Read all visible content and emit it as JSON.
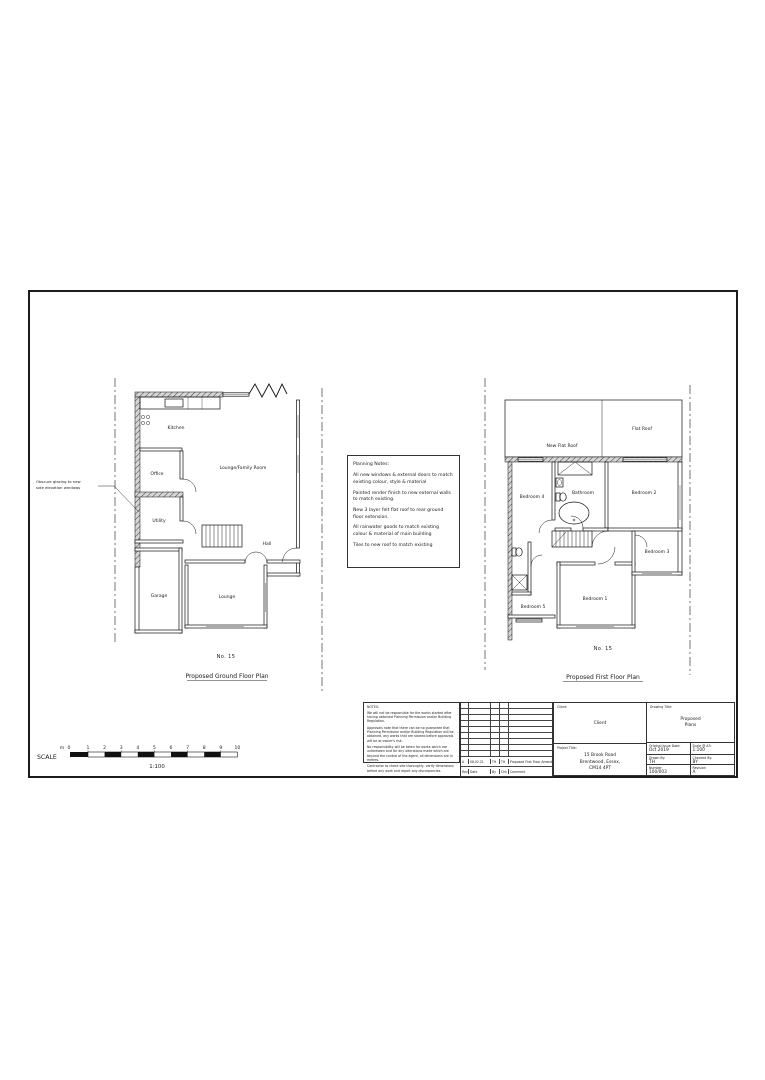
{
  "sheet": {
    "ink_color": "#1a1a1a",
    "ground_plan": {
      "annotation_lines": [
        "Obscure glazing to new",
        "side elevation windows"
      ],
      "rooms": {
        "kitchen": "Kitchen",
        "office": "Office",
        "utility": "Utility",
        "lounge_family": "Lounge/Family Room",
        "hall": "Hall",
        "garage": "Garage",
        "lounge": "Lounge"
      },
      "house_number": "No. 15",
      "caption": "Proposed Ground Floor Plan"
    },
    "first_plan": {
      "rooms": {
        "new_flat_roof": "New Flat Roof",
        "flat_roof": "Flat Roof",
        "bedroom4": "Bedroom 4",
        "bathroom": "Bathroom",
        "bedroom2": "Bedroom 2",
        "bedroom3": "Bedroom 3",
        "bedroom1": "Bedroom 1",
        "bedroom5": "Bedroom 5"
      },
      "house_number": "No. 15",
      "caption": "Proposed First Floor Plan"
    },
    "planning_notes": {
      "title": "Planning Notes:",
      "items": [
        "All new windows & external doors to match existing colour, style & material",
        "Painted render finish to new external walls to match existing.",
        "New 3 layer felt flat roof to rear ground floor extension.",
        "All rainwater goods to match existing colour & material of main building",
        "Tiles to new roof to match existing"
      ]
    },
    "scale_bar": {
      "label": "SCALE",
      "unit": "m",
      "ticks": [
        "0",
        "1",
        "2",
        "3",
        "4",
        "5",
        "6",
        "7",
        "8",
        "9",
        "10"
      ],
      "ratio": "1:100"
    },
    "notes_block": {
      "title": "NOTES:",
      "paragraphs": [
        "We will not be responsible for the works started after having obtained Planning Permission and/or Building Regulation.",
        "Approvals note that there can be no guarantee that Planning Permission and/or Building Regulation will be obtained, any works that are started before approvals will be at owner's risk.",
        "No responsibility will be taken for works which are unforeseen and for any alterations made which are beyond the control of the agent, all dimensions are in metres.",
        "Contractor to check site thoroughly, verify dimensions before any work and report any discrepancies."
      ]
    },
    "revision_table": {
      "rows": [
        [
          "A",
          "06.02.21",
          "TH",
          "TH",
          "Proposed First Floor Amended"
        ]
      ],
      "header": [
        "Rev",
        "Date",
        "By",
        "Chk",
        "Comment"
      ]
    },
    "title_block": {
      "client_label": "Client:",
      "client": "Client",
      "project_label": "Project Title:",
      "project_lines": [
        "15 Brook Road",
        "Brentwood, Essex,",
        "CM14 4PT"
      ],
      "drawing_title_label": "Drawing Title:",
      "drawing_title_lines": [
        "Proposed",
        "Plans"
      ],
      "fields": [
        {
          "label": "Original Issue Date:",
          "value": "Oct 2019"
        },
        {
          "label": "Scale @ A3:",
          "value": "1:100"
        },
        {
          "label": "Drawn By:",
          "value": "TH"
        },
        {
          "label": "Checked By:",
          "value": "BY"
        },
        {
          "label": "Number",
          "value": "100/003"
        },
        {
          "label": "Revision",
          "value": "A"
        }
      ]
    }
  }
}
